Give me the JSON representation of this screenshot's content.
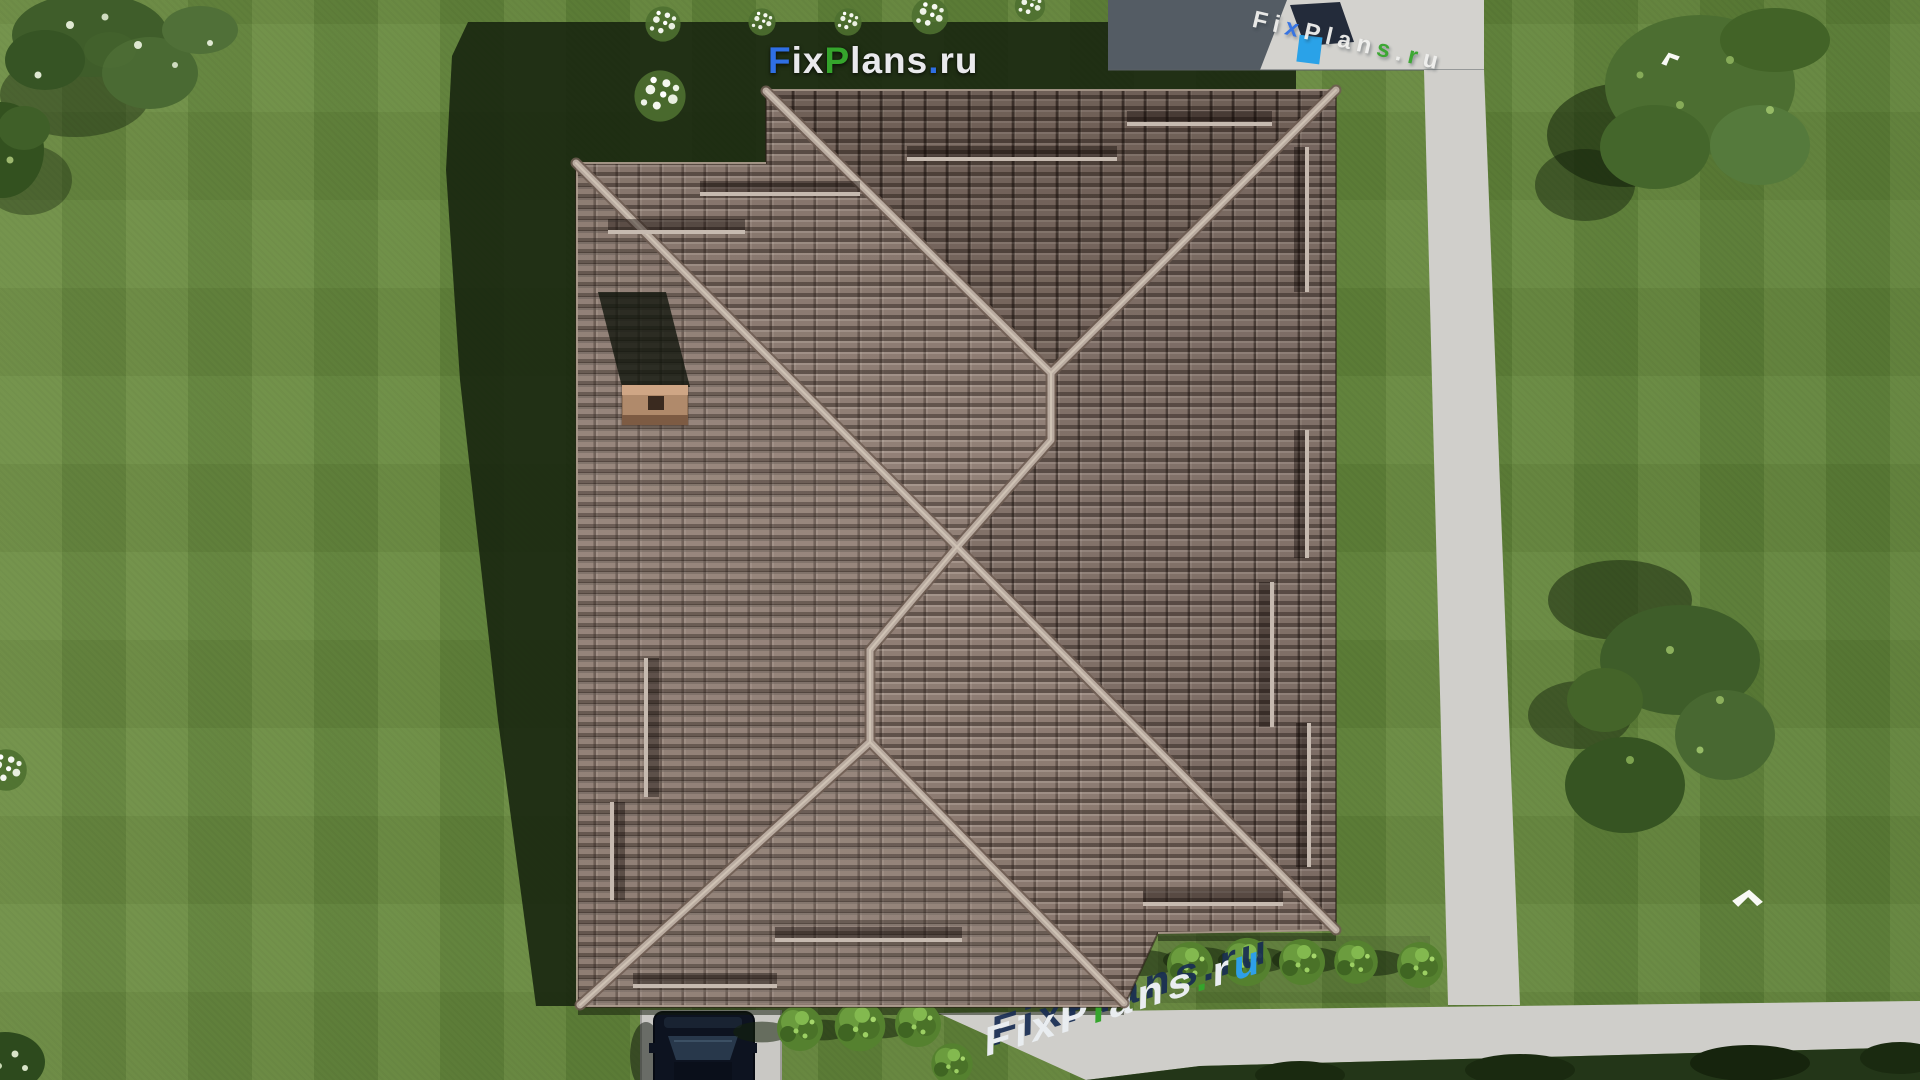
{
  "scene": {
    "brand": "FixPlans.ru",
    "watermark_top": {
      "text": "FixPlans.ru",
      "letters": [
        {
          "ch": "F",
          "color": "#2f6fe4"
        },
        {
          "ch": "i",
          "color": "#e9e9ec"
        },
        {
          "ch": "x",
          "color": "#e9e9ec"
        },
        {
          "ch": "P",
          "color": "#35a52c"
        },
        {
          "ch": "l",
          "color": "#e9e9ec"
        },
        {
          "ch": "a",
          "color": "#e9e9ec"
        },
        {
          "ch": "n",
          "color": "#e9e9ec"
        },
        {
          "ch": "s",
          "color": "#e9e9ec"
        },
        {
          "ch": ".",
          "color": "#2f6fe4"
        },
        {
          "ch": "r",
          "color": "#e9e9ec"
        },
        {
          "ch": "u",
          "color": "#e9e9ec"
        }
      ]
    },
    "watermark_ground": {
      "text": "FixPlans.ru",
      "letters": [
        {
          "ch": "F",
          "color": "#e9edf0"
        },
        {
          "ch": "i",
          "color": "#e9edf0"
        },
        {
          "ch": "x",
          "color": "#e9edf0"
        },
        {
          "ch": "P",
          "color": "#e9edf0"
        },
        {
          "ch": "l",
          "color": "#35a52c"
        },
        {
          "ch": "a",
          "color": "#e9edf0"
        },
        {
          "ch": "n",
          "color": "#e9edf0"
        },
        {
          "ch": "s",
          "color": "#e9edf0"
        },
        {
          "ch": ".",
          "color": "#35a52c"
        },
        {
          "ch": "r",
          "color": "#e9edf0"
        },
        {
          "ch": "u",
          "color": "#2e9fe8"
        }
      ]
    },
    "watermark_terrace": {
      "text": "FixPlans.ru",
      "letters": [
        {
          "ch": "F",
          "color": "#f0f0ee"
        },
        {
          "ch": "i",
          "color": "#f0f0ee"
        },
        {
          "ch": "x",
          "color": "#2f6fe4"
        },
        {
          "ch": "P",
          "color": "#f0f0ee"
        },
        {
          "ch": "l",
          "color": "#f0f0ee"
        },
        {
          "ch": "a",
          "color": "#f0f0ee"
        },
        {
          "ch": "n",
          "color": "#f0f0ee"
        },
        {
          "ch": "s",
          "color": "#35a52c"
        },
        {
          "ch": ".",
          "color": "#f0f0ee"
        },
        {
          "ch": "r",
          "color": "#35a52c"
        },
        {
          "ch": "u",
          "color": "#f0f0ee"
        }
      ]
    },
    "palette": {
      "grass": "#64873c",
      "grass_shadow": "#16230e",
      "roof_tile": "#8d7b71",
      "roof_ridge_light": "#b9aba0",
      "path_light": "#d0cfcb",
      "path_shadow": "#545c64",
      "driveway": "#c9c8c4",
      "car_body": "#0d1320",
      "chimney": "#b08a6b",
      "bush_green": "#55812f",
      "tree_green": "#3f5d2a",
      "flower_white": "#eef3e8",
      "bird_white": "#f8f9f5",
      "watermark_blue": "#2f6fe4",
      "watermark_green": "#35a52c",
      "watermark_navy": "#182c52"
    },
    "objects": {
      "house_roofs": 1,
      "chimneys": 1,
      "cars": 1,
      "birds": 2,
      "trees": 5,
      "shrub_rows": 2,
      "shrubs_right_row": 5,
      "shrubs_bottom_row": 4,
      "flower_clusters": 7,
      "paths": 3
    }
  }
}
